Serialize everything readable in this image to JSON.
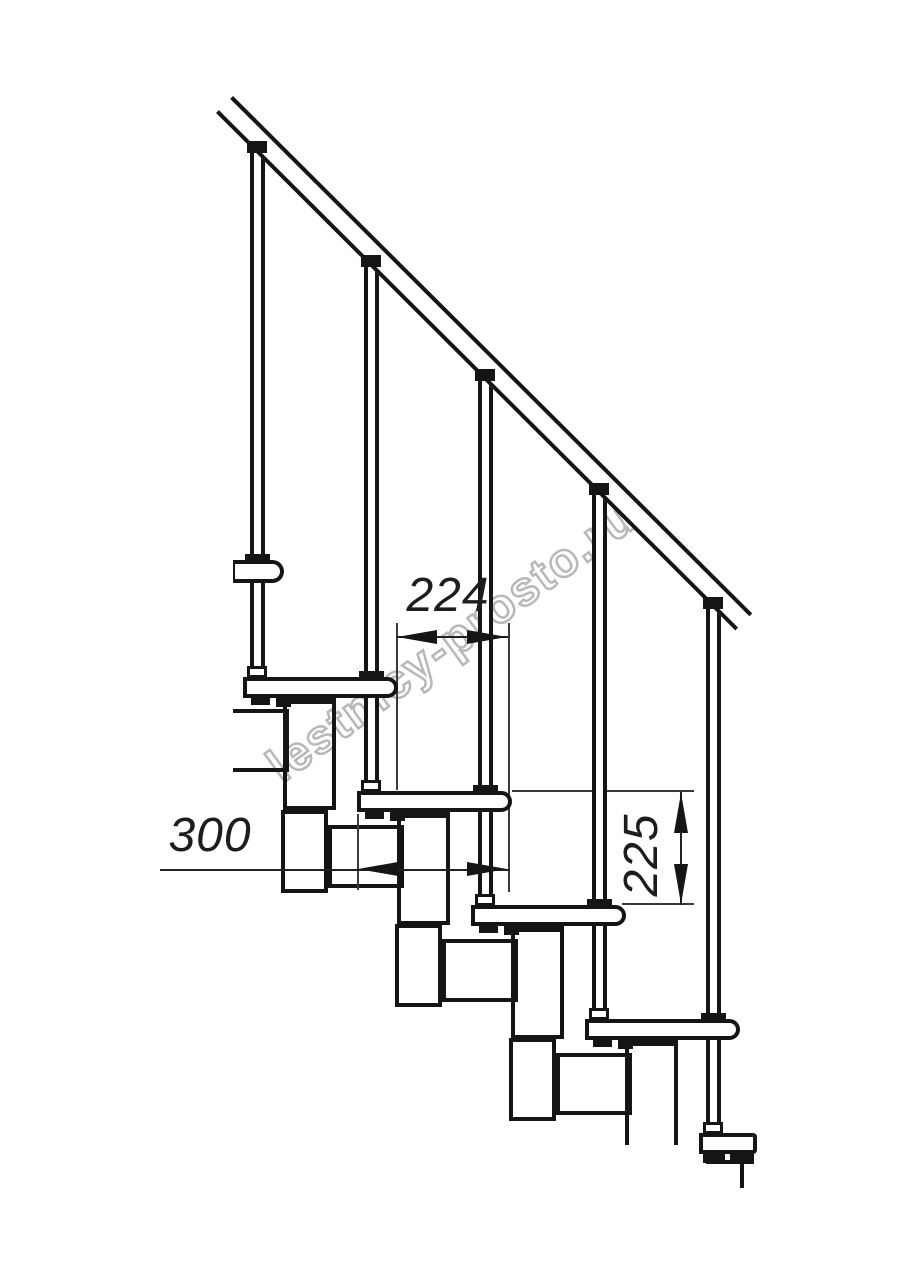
{
  "watermark": {
    "text": "lestnicy-prosto.ru"
  },
  "dimensions": {
    "horizontal_step": "224",
    "tread_depth": "300",
    "riser_height": "225"
  },
  "colors": {
    "line": "#151515",
    "thin_line": "#3a3a3a",
    "watermark_stroke": "#b8b8b8",
    "background": "#ffffff"
  },
  "drawing": {
    "subject": "modular-staircase-side-elevation",
    "tread_count": 6,
    "baluster_count": 5
  }
}
